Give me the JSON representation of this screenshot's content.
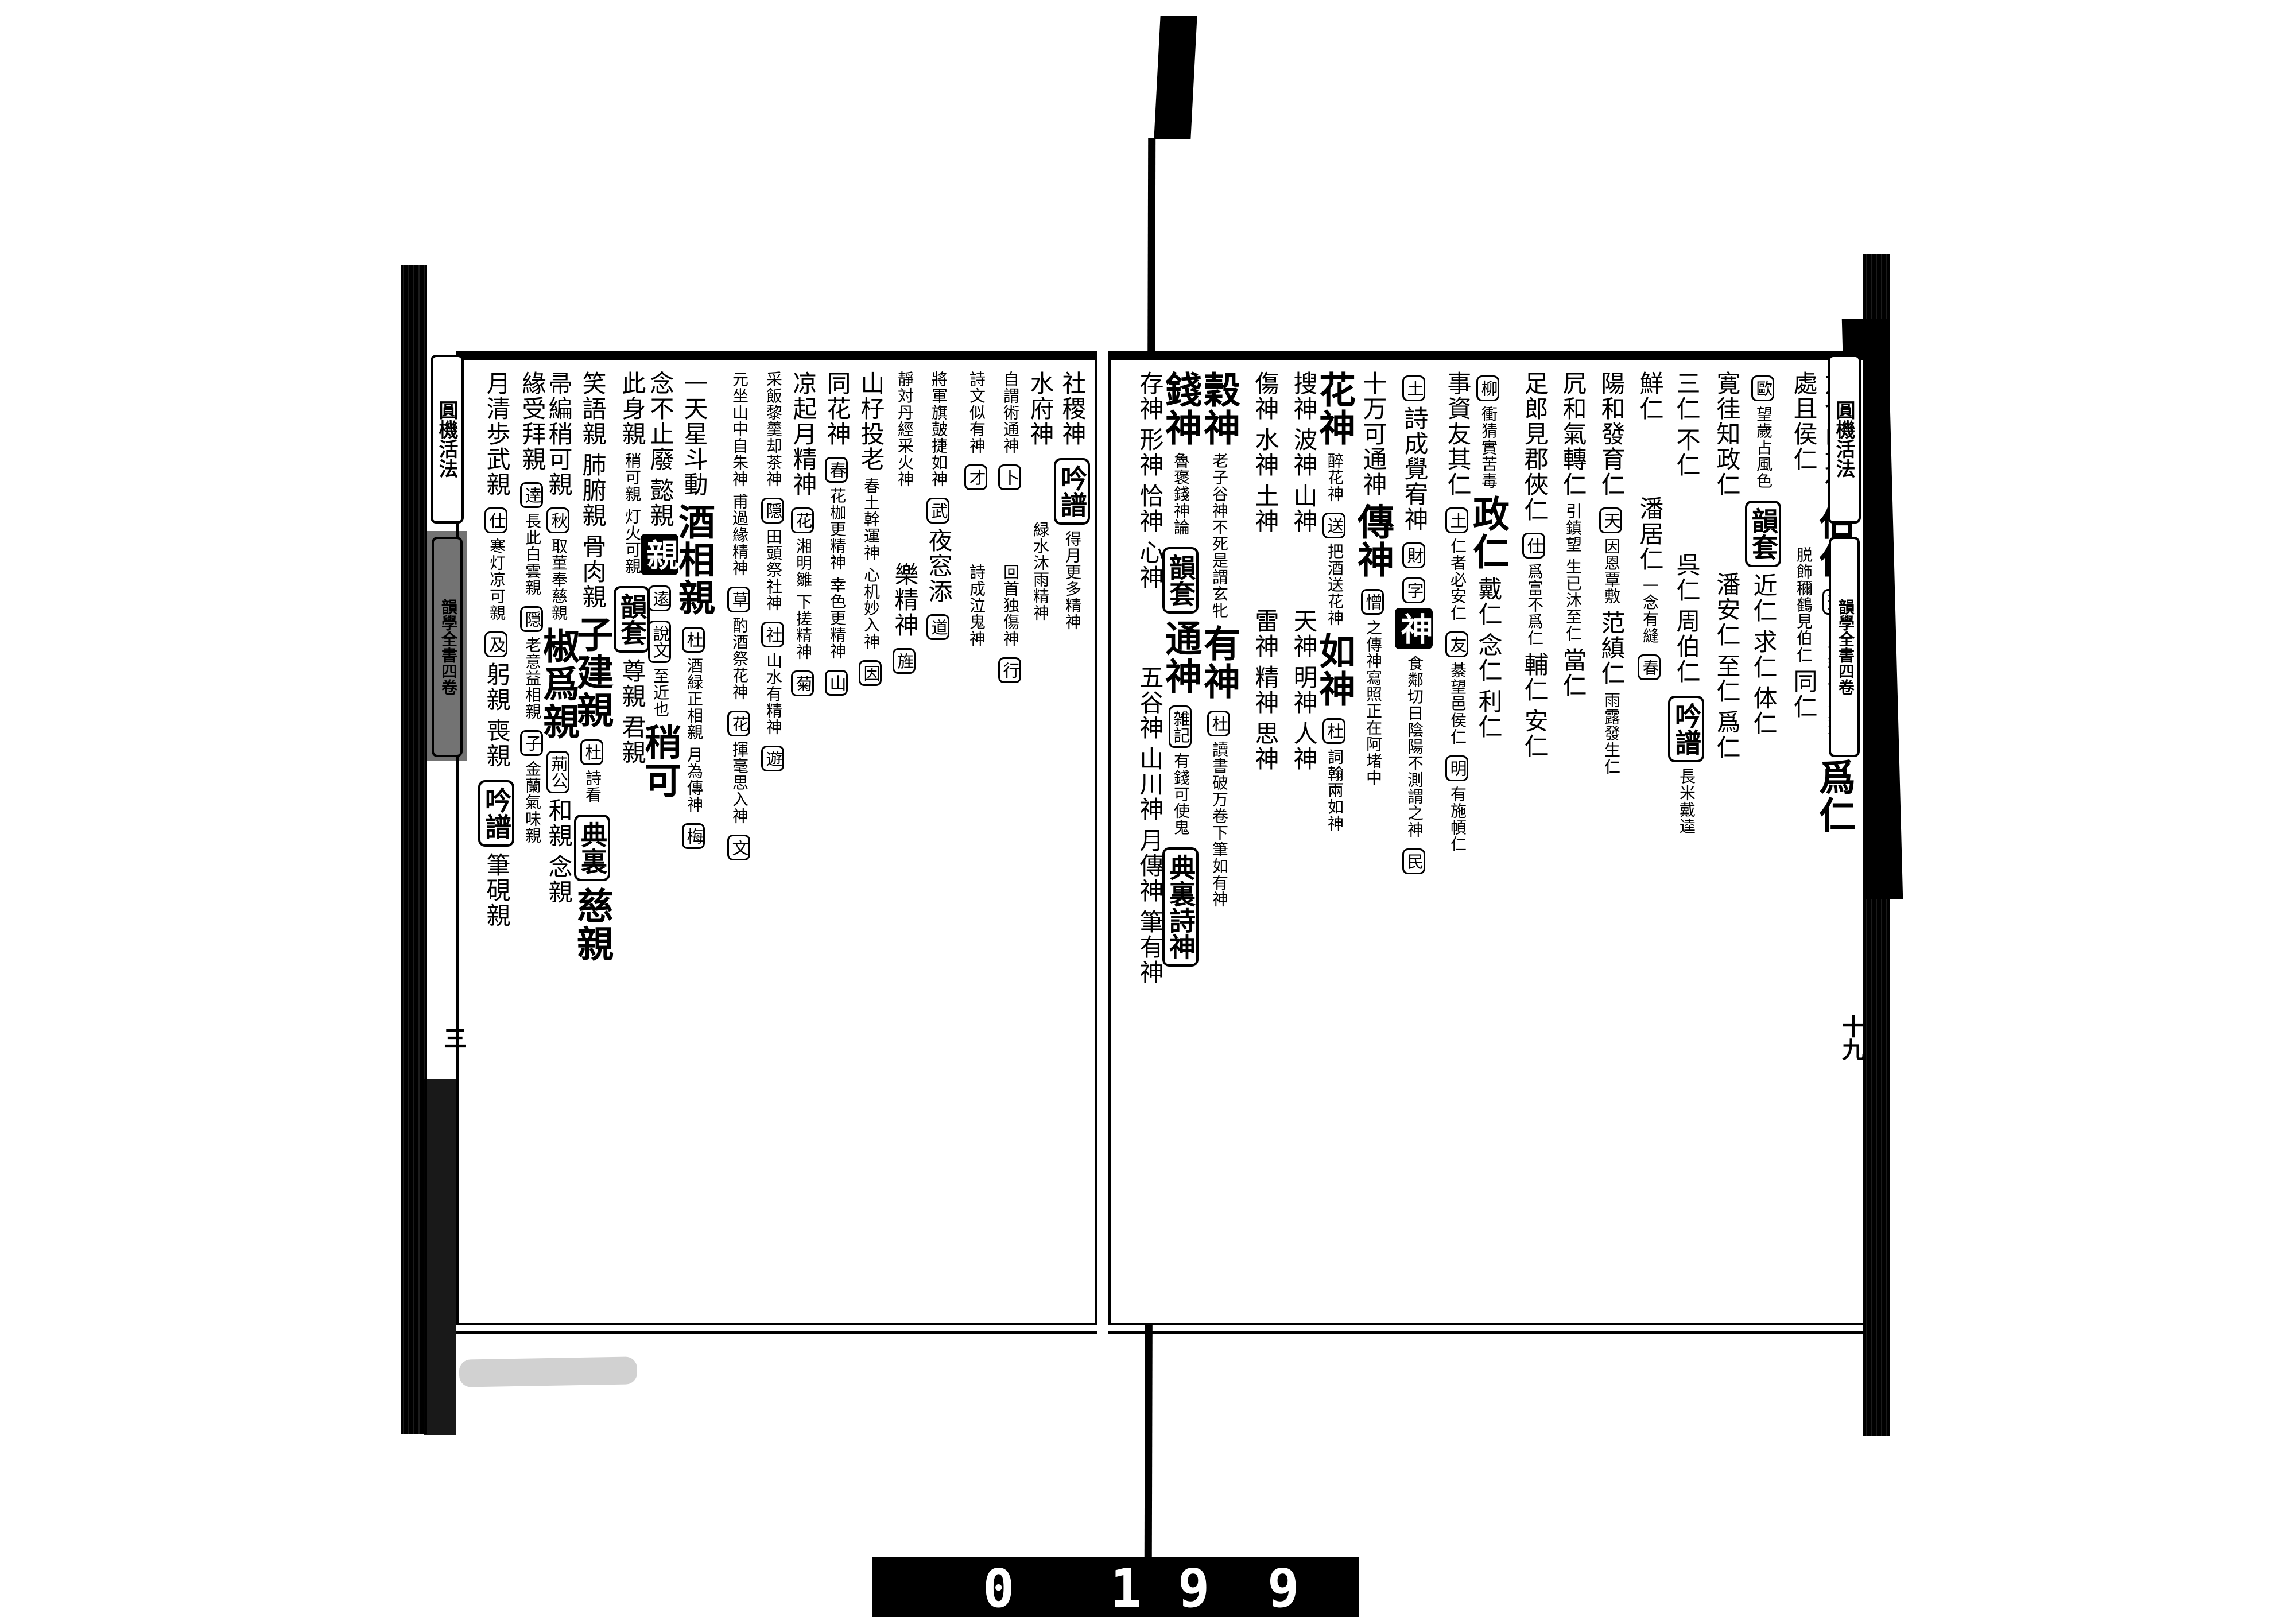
{
  "meta": {
    "title": "圓機活法"
  },
  "film": {
    "counter_digits": [
      "0",
      "1",
      "9",
      "9"
    ]
  },
  "edges": {
    "left": {
      "title": "圓機活法",
      "volume": "韻學全書四卷",
      "folio": "三"
    },
    "right": {
      "title": "圓機活法",
      "volume": "韻學全書四卷",
      "folio": "十九"
    }
  },
  "pages": {
    "right": {
      "columns": [
        [
          {
            "t": "方今尚武何",
            "s": "p"
          },
          {
            "t": "伯仁",
            "s": "h"
          },
          {
            "t": "蘇",
            "s": "b"
          },
          {
            "t": "當年織履隨方進ヲ",
            "s": "s"
          },
          {
            "t": "爲仁",
            "s": "h"
          }
        ],
        [
          {
            "t": "處且侯仁",
            "s": "p"
          },
          {
            "t": "",
            "s": "g"
          },
          {
            "t": "脱飾穪鶴見伯仁",
            "s": "s"
          },
          {
            "t": "同仁",
            "s": "p"
          }
        ],
        [
          {
            "t": "歐",
            "s": "b"
          },
          {
            "t": "望歲占風色",
            "s": "s"
          },
          {
            "t": "韻套",
            "s": "B"
          },
          {
            "t": "近仁",
            "s": "p"
          },
          {
            "t": "求仁",
            "s": "p"
          },
          {
            "t": "体仁",
            "s": "p"
          }
        ],
        [
          {
            "t": "寛徍知政仁",
            "s": "p"
          },
          {
            "t": "",
            "s": "g"
          },
          {
            "t": "潘安仁",
            "s": "p"
          },
          {
            "t": "至仁",
            "s": "p"
          },
          {
            "t": "爲仁",
            "s": "p"
          }
        ],
        [
          {
            "t": "三仁",
            "s": "p"
          },
          {
            "t": "不仁",
            "s": "p"
          },
          {
            "t": "",
            "s": "g"
          },
          {
            "t": "呉仁",
            "s": "p"
          },
          {
            "t": "周伯仁",
            "s": "p"
          },
          {
            "t": "吟譜",
            "s": "B"
          },
          {
            "t": "長米戴逵",
            "s": "s"
          }
        ],
        [
          {
            "t": "鮮仁",
            "s": "p"
          },
          {
            "t": "",
            "s": "g"
          },
          {
            "t": "潘居仁",
            "s": "p"
          },
          {
            "t": "一念有縫",
            "s": "s"
          },
          {
            "t": "春",
            "s": "b"
          }
        ],
        [
          {
            "t": "陽和發育仁",
            "s": "p"
          },
          {
            "t": "天",
            "s": "b"
          },
          {
            "t": "因恩覃敷",
            "s": "s"
          },
          {
            "t": "范縝仁",
            "s": "p"
          },
          {
            "t": "雨露發生仁",
            "s": "s"
          }
        ],
        [
          {
            "t": "凥和氣轉仁",
            "s": "p"
          },
          {
            "t": "引鎮望",
            "s": "s"
          },
          {
            "t": "生已沐至仁",
            "s": "s"
          },
          {
            "t": "當仁",
            "s": "p"
          }
        ],
        [
          {
            "t": "足郎見郡俠仁",
            "s": "p"
          },
          {
            "t": "仕",
            "s": "b"
          },
          {
            "t": "爲富不爲仁",
            "s": "s"
          },
          {
            "t": "輔仁",
            "s": "p"
          },
          {
            "t": "安仁",
            "s": "p"
          }
        ],
        [
          {
            "t": "柳",
            "s": "b"
          },
          {
            "t": "衝猜實苦毒",
            "s": "s"
          },
          {
            "t": "政仁",
            "s": "h"
          },
          {
            "t": "戴仁",
            "s": "p"
          },
          {
            "t": "念仁",
            "s": "p"
          },
          {
            "t": "利仁",
            "s": "p"
          }
        ],
        [
          {
            "t": "事資友其仁",
            "s": "p"
          },
          {
            "t": "土",
            "s": "b"
          },
          {
            "t": "仁者必安仁",
            "s": "s"
          },
          {
            "t": "友",
            "s": "b"
          },
          {
            "t": "綦望邑侯仁",
            "s": "s"
          },
          {
            "t": "明",
            "s": "b"
          },
          {
            "t": "有施幁仁",
            "s": "s"
          }
        ],
        [
          {
            "t": "土",
            "s": "b"
          },
          {
            "t": "詩成覺宥神",
            "s": "p"
          },
          {
            "t": "財",
            "s": "b"
          },
          {
            "t": "字",
            "s": "b"
          },
          {
            "t": "神",
            "s": "f"
          },
          {
            "t": "食鄰切日陰陽不測謂之神",
            "s": "s"
          },
          {
            "t": "民",
            "s": "b"
          }
        ],
        [
          {
            "t": "十万可通神",
            "s": "p"
          },
          {
            "t": "傳神",
            "s": "h"
          },
          {
            "t": "憎",
            "s": "b"
          },
          {
            "t": "之傳神寫照正在阿堵中",
            "s": "s"
          }
        ],
        [
          {
            "t": "花神",
            "s": "h"
          },
          {
            "t": "醉花神",
            "s": "s"
          },
          {
            "t": "送",
            "s": "b"
          },
          {
            "t": "把酒送花神",
            "s": "s"
          },
          {
            "t": "如神",
            "s": "h"
          },
          {
            "t": "杜",
            "s": "b"
          },
          {
            "t": "詞翰兩如神",
            "s": "s"
          }
        ],
        [
          {
            "t": "搜神",
            "s": "p"
          },
          {
            "t": "波神",
            "s": "p"
          },
          {
            "t": "山神",
            "s": "p"
          },
          {
            "t": "",
            "s": "g"
          },
          {
            "t": "天神",
            "s": "p"
          },
          {
            "t": "明神",
            "s": "p"
          },
          {
            "t": "人神",
            "s": "p"
          }
        ],
        [
          {
            "t": "傷神",
            "s": "p"
          },
          {
            "t": "水神",
            "s": "p"
          },
          {
            "t": "土神",
            "s": "p"
          },
          {
            "t": "",
            "s": "g"
          },
          {
            "t": "雷神",
            "s": "p"
          },
          {
            "t": "精神",
            "s": "p"
          },
          {
            "t": "思神",
            "s": "p"
          }
        ],
        [
          {
            "t": "穀神",
            "s": "h"
          },
          {
            "t": "老子谷神不死是謂玄牝",
            "s": "s"
          },
          {
            "t": "有神",
            "s": "h"
          },
          {
            "t": "杜",
            "s": "b"
          },
          {
            "t": "讀書破万卷下筆如有神",
            "s": "s"
          }
        ],
        [
          {
            "t": "錢神",
            "s": "h"
          },
          {
            "t": "魯褒錢神論",
            "s": "s"
          },
          {
            "t": "韻套",
            "s": "B"
          },
          {
            "t": "通神",
            "s": "h"
          },
          {
            "t": "雑記",
            "s": "b"
          },
          {
            "t": "有錢可使鬼",
            "s": "s"
          },
          {
            "t": "典裏詩神",
            "s": "B"
          }
        ],
        [
          {
            "t": "存神",
            "s": "p"
          },
          {
            "t": "形神",
            "s": "p"
          },
          {
            "t": "恰神",
            "s": "p"
          },
          {
            "t": "心神",
            "s": "p"
          },
          {
            "t": "",
            "s": "g"
          },
          {
            "t": "五谷神",
            "s": "p"
          },
          {
            "t": "山川神",
            "s": "p"
          },
          {
            "t": "月傳神",
            "s": "p"
          },
          {
            "t": "筆有神",
            "s": "p"
          }
        ]
      ]
    },
    "left": {
      "columns": [
        [
          {
            "t": "社稷神",
            "s": "p"
          },
          {
            "t": "吟譜",
            "s": "B"
          },
          {
            "t": "得月更多精神",
            "s": "s"
          }
        ],
        [
          {
            "t": "水府神",
            "s": "p"
          },
          {
            "t": "",
            "s": "g"
          },
          {
            "t": "緑水沐雨精神",
            "s": "s"
          }
        ],
        [
          {
            "t": "自謂術通神",
            "s": "s"
          },
          {
            "t": "卜",
            "s": "b"
          },
          {
            "t": "",
            "s": "g"
          },
          {
            "t": "回首独傷神",
            "s": "s"
          },
          {
            "t": "行",
            "s": "b"
          }
        ],
        [
          {
            "t": "詩文似有神",
            "s": "s"
          },
          {
            "t": "才",
            "s": "b"
          },
          {
            "t": "",
            "s": "g"
          },
          {
            "t": "詩成泣鬼神",
            "s": "s"
          }
        ],
        [
          {
            "t": "將軍旗皷捷如神",
            "s": "s"
          },
          {
            "t": "武",
            "s": "b"
          },
          {
            "t": "夜窓添",
            "s": "p"
          },
          {
            "t": "道",
            "s": "b"
          }
        ],
        [
          {
            "t": "靜対丹經采火神",
            "s": "s"
          },
          {
            "t": "",
            "s": "g"
          },
          {
            "t": "樂精神",
            "s": "p"
          },
          {
            "t": "旌",
            "s": "b"
          }
        ],
        [
          {
            "t": "山杍投老",
            "s": "p"
          },
          {
            "t": "春土幹運神",
            "s": "s"
          },
          {
            "t": "心机妙入神",
            "s": "s"
          },
          {
            "t": "因",
            "s": "b"
          }
        ],
        [
          {
            "t": "同花神",
            "s": "p"
          },
          {
            "t": "春",
            "s": "b"
          },
          {
            "t": "花枷更精神",
            "s": "s"
          },
          {
            "t": "幸色更精神",
            "s": "s"
          },
          {
            "t": "山",
            "s": "b"
          }
        ],
        [
          {
            "t": "凉起月精神",
            "s": "p"
          },
          {
            "t": "花",
            "s": "b"
          },
          {
            "t": "湘明雛",
            "s": "s"
          },
          {
            "t": "下搓精神",
            "s": "s"
          },
          {
            "t": "菊",
            "s": "b"
          }
        ],
        [
          {
            "t": "采飯黎羹却茶神",
            "s": "s"
          },
          {
            "t": "隠",
            "s": "b"
          },
          {
            "t": "田頭祭社神",
            "s": "s"
          },
          {
            "t": "社",
            "s": "b"
          },
          {
            "t": "山水有精神",
            "s": "s"
          },
          {
            "t": "遊",
            "s": "b"
          }
        ],
        [
          {
            "t": "元坐山中自朱神",
            "s": "s"
          },
          {
            "t": "甫過緣精神",
            "s": "s"
          },
          {
            "t": "草",
            "s": "b"
          },
          {
            "t": "酌酒祭花神",
            "s": "s"
          },
          {
            "t": "花",
            "s": "b"
          },
          {
            "t": "揮毫思入神",
            "s": "s"
          },
          {
            "t": "文",
            "s": "b"
          }
        ],
        [
          {
            "t": "一天星斗動",
            "s": "p"
          },
          {
            "t": "酒相親",
            "s": "h"
          },
          {
            "t": "杜",
            "s": "b"
          },
          {
            "t": "酒緑正相親",
            "s": "s"
          },
          {
            "t": "月為傳神",
            "s": "s"
          },
          {
            "t": "梅",
            "s": "b"
          }
        ],
        [
          {
            "t": "念不止廢",
            "s": "p"
          },
          {
            "t": "懿親",
            "s": "p"
          },
          {
            "t": "親",
            "s": "f"
          },
          {
            "t": "逺",
            "s": "b"
          },
          {
            "t": "說文",
            "s": "b"
          },
          {
            "t": "至近也",
            "s": "s"
          },
          {
            "t": "稍可",
            "s": "h"
          }
        ],
        [
          {
            "t": "此身親",
            "s": "p"
          },
          {
            "t": "稍可親",
            "s": "s"
          },
          {
            "t": "灯火可親",
            "s": "s"
          },
          {
            "t": "韻套",
            "s": "B"
          },
          {
            "t": "尊親",
            "s": "p"
          },
          {
            "t": "君親",
            "s": "p"
          }
        ],
        [
          {
            "t": "笑語親",
            "s": "p"
          },
          {
            "t": "肺腑親",
            "s": "p"
          },
          {
            "t": "骨肉親",
            "s": "p"
          },
          {
            "t": "子建親",
            "s": "h"
          },
          {
            "t": "杜",
            "s": "b"
          },
          {
            "t": "詩看",
            "s": "s"
          },
          {
            "t": "典裏",
            "s": "B"
          },
          {
            "t": "慈親",
            "s": "h"
          }
        ],
        [
          {
            "t": "帚編稍可親",
            "s": "p"
          },
          {
            "t": "秋",
            "s": "b"
          },
          {
            "t": "取菫奉慈親",
            "s": "s"
          },
          {
            "t": "椒爲親",
            "s": "h"
          },
          {
            "t": "荊公",
            "s": "b"
          },
          {
            "t": "和親",
            "s": "p"
          },
          {
            "t": "念親",
            "s": "p"
          }
        ],
        [
          {
            "t": "緣受拜親",
            "s": "p"
          },
          {
            "t": "逹",
            "s": "b"
          },
          {
            "t": "長此白雲親",
            "s": "s"
          },
          {
            "t": "隠",
            "s": "b"
          },
          {
            "t": "老意益相親",
            "s": "s"
          },
          {
            "t": "子",
            "s": "b"
          },
          {
            "t": "金蘭氣味親",
            "s": "s"
          }
        ],
        [
          {
            "t": "月清歩武親",
            "s": "p"
          },
          {
            "t": "仕",
            "s": "b"
          },
          {
            "t": "寒灯凉可親",
            "s": "s"
          },
          {
            "t": "及",
            "s": "b"
          },
          {
            "t": "躬親",
            "s": "p"
          },
          {
            "t": "喪親",
            "s": "p"
          },
          {
            "t": "吟譜",
            "s": "B"
          },
          {
            "t": "筆硯親",
            "s": "p"
          }
        ]
      ]
    }
  }
}
